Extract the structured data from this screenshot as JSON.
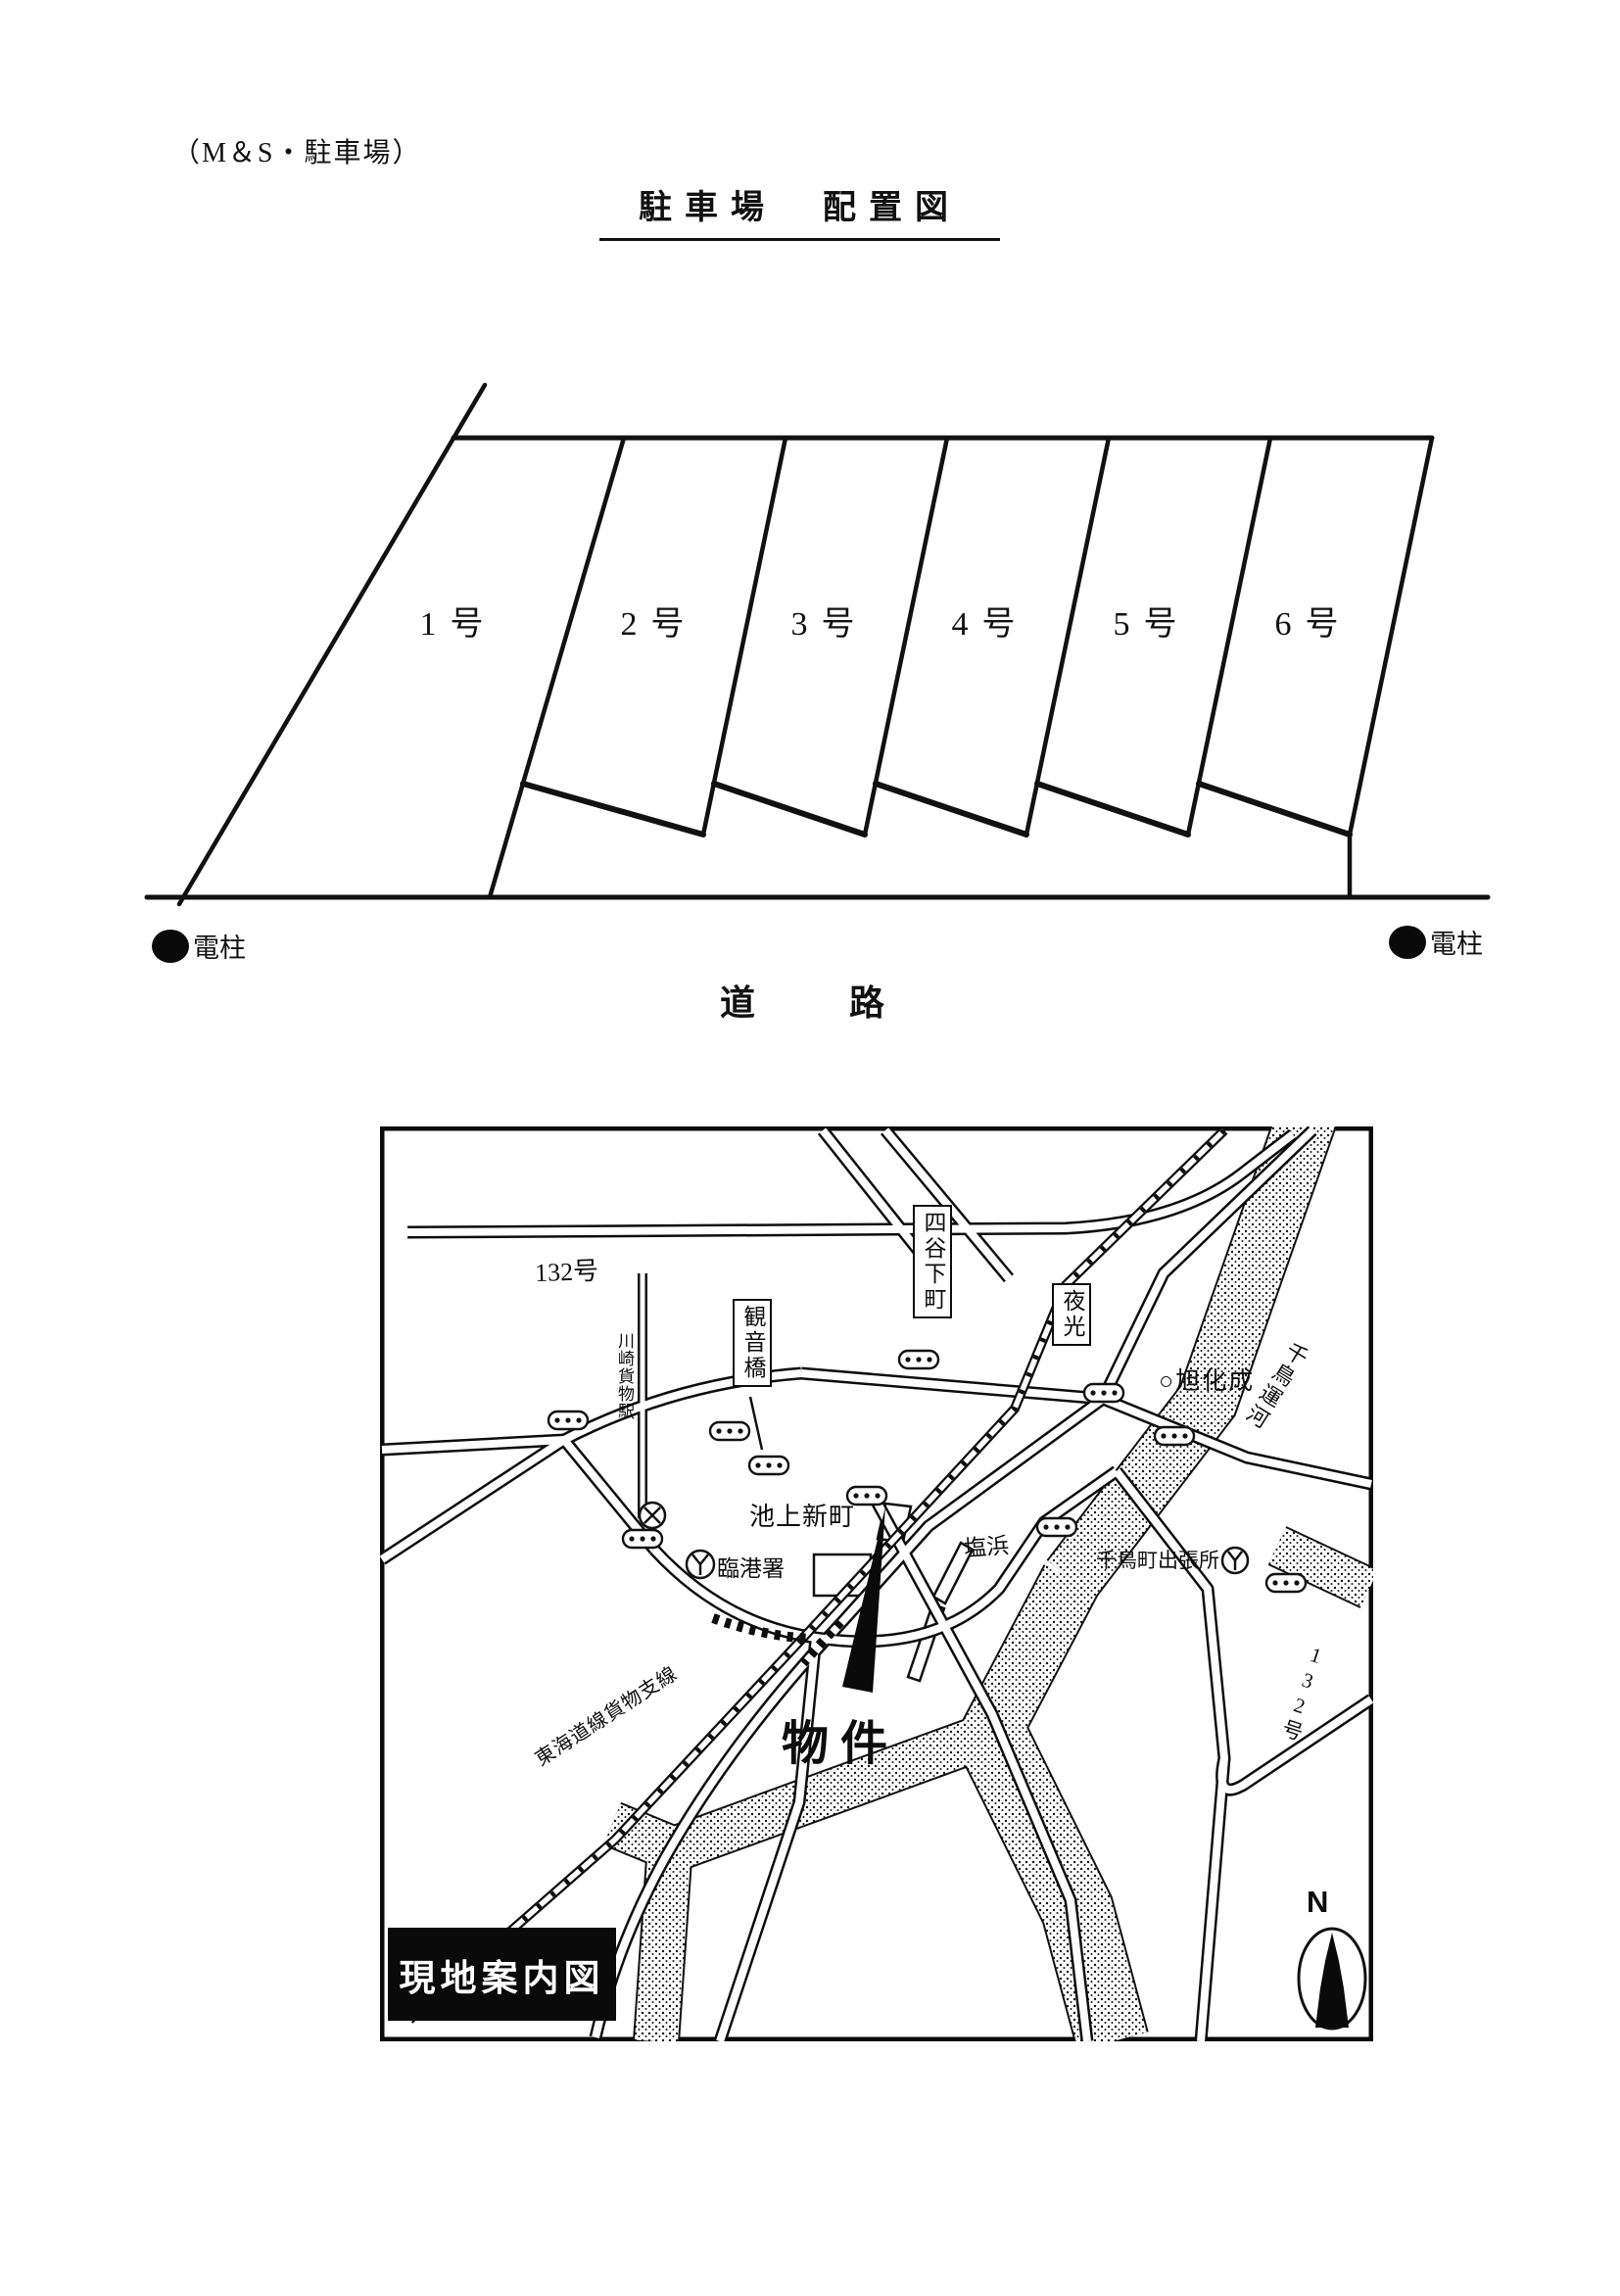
{
  "document": {
    "header_note": "（M＆S・駐車場）",
    "title": "駐車場　配置図"
  },
  "parking_diagram": {
    "stalls": [
      "1号",
      "2号",
      "3号",
      "4号",
      "5号",
      "6号"
    ],
    "left_pole_label": "電柱",
    "right_pole_label": "電柱",
    "road_label": "道　　路"
  },
  "map": {
    "frame_title": "現地案内図",
    "compass_label": "N",
    "labels": {
      "route_132_top": "132号",
      "yotsuya_shimocho": "四谷下町",
      "kannon_bashi": "観音橋",
      "yako": "夜光",
      "asahi_kasei": "○旭化成",
      "chidori_unga": "千鳥運河",
      "kawasaki_kamotsu_eki": "川崎貨物駅",
      "ikegami_shinmachi": "池上新町",
      "rinko_sho": "臨港署",
      "shiohama": "塩浜",
      "chidoricho_shutchosho": "千鳥町出張所",
      "route_132_bottom": "132号",
      "tokaido_freight": "東海道線貨物支線",
      "property": "物件"
    },
    "icons": {
      "signal_marker": "capsule-with-dots",
      "station_mark": "x-in-circle",
      "fire_station_mark": "y-in-circle",
      "utility_pole": "filled-circle",
      "north_arrow": "compass-spike-in-ellipse"
    }
  },
  "colors": {
    "ink": "#111111",
    "paper": "#ffffff"
  }
}
